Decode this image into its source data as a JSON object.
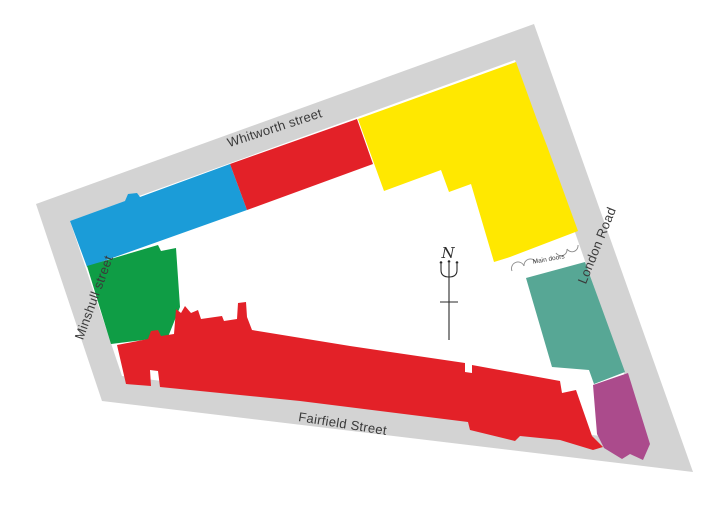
{
  "map": {
    "type": "site-plan",
    "streets": [
      {
        "id": "whitworth",
        "label": "Whitworth street"
      },
      {
        "id": "minshull",
        "label": "Minshull street"
      },
      {
        "id": "fairfield",
        "label": "Fairfield Street"
      },
      {
        "id": "london_road",
        "label": "London Road"
      }
    ],
    "annotations": {
      "main_doors": "Main doors",
      "compass_north": "N"
    },
    "colors": {
      "page_background": "#ffffff",
      "street_band": "#d3d3d3",
      "block_interior": "#ffffff",
      "label_text": "#3a3a3a",
      "compass": "#2a2a2a",
      "door_arc": "#8a8a8a",
      "blue_building": "#1b9cd8",
      "red_building": "#e32128",
      "yellow_building": "#ffe800",
      "green_building": "#0f9d45",
      "teal_building": "#57a795",
      "purple_building": "#ab4b8c"
    }
  }
}
